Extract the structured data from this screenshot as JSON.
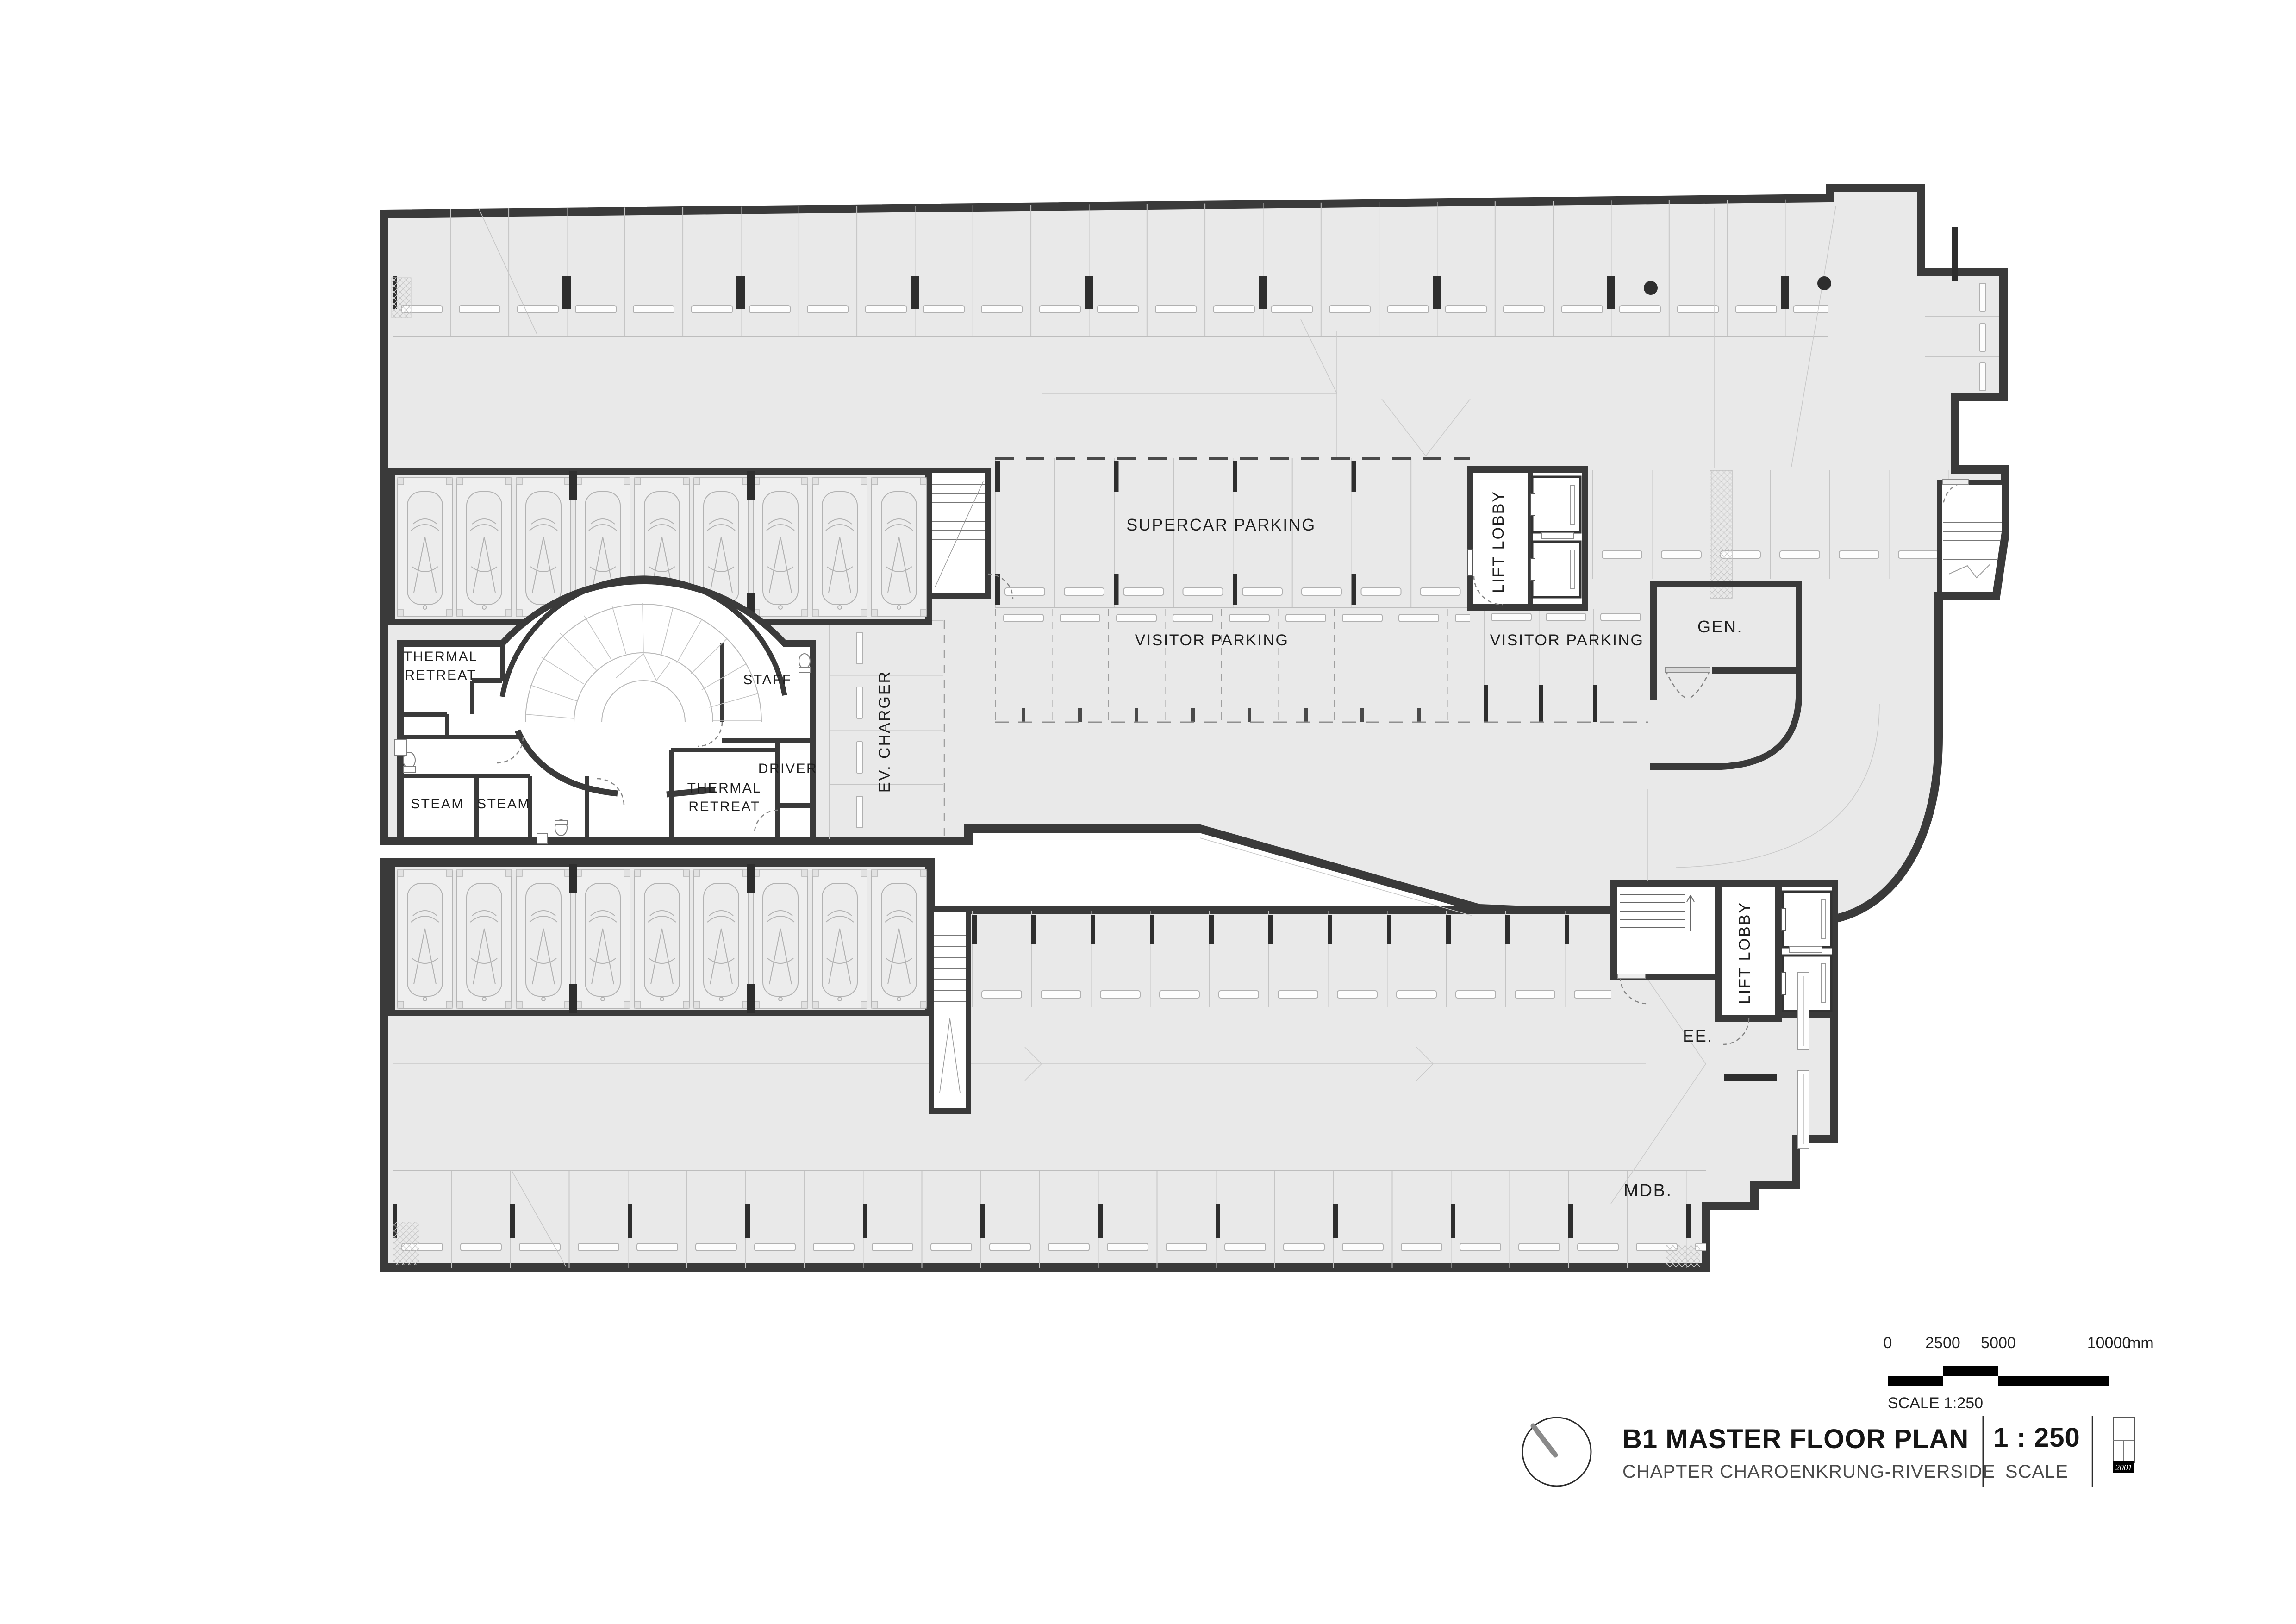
{
  "labels": {
    "supercar_parking": "SUPERCAR PARKING",
    "visitor_parking": "VISITOR PARKING",
    "lift_lobby": "LIFT LOBBY",
    "generator": "GEN.",
    "thermal_retreat": {
      "line1": "THERMAL",
      "line2": "RETREAT"
    },
    "staff": "STAFF",
    "driver": "DRIVER",
    "steam": "STEAM",
    "ev_charger": "EV. CHARGER",
    "electrical_room": "EE.",
    "mdb_room": "MDB."
  },
  "scale_bar": {
    "ticks": [
      "0",
      "2500",
      "5000",
      "10000"
    ],
    "unit": "mm",
    "caption": "SCALE 1:250"
  },
  "title_block": {
    "title": "B1 MASTER FLOOR PLAN",
    "subtitle": "CHAPTER CHAROENKRUNG-RIVERSIDE",
    "scale_value": "1 : 250",
    "scale_label": "SCALE",
    "key_plan_code": "2001"
  },
  "colors": {
    "floor": "#e9e9e9",
    "wall": "#3a3a3a",
    "stall_line": "#c5c5c5",
    "column": "#2e2e2e",
    "text": "#1e1e1e"
  }
}
